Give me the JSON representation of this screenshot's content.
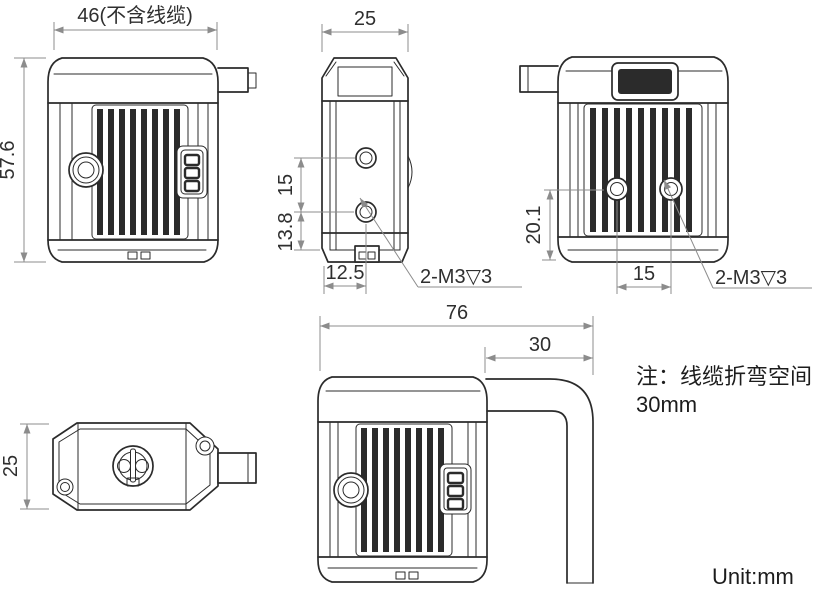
{
  "page": {
    "unit": "Unit:mm",
    "note_line1": "注：线缆折弯空间",
    "note_line2": "30mm"
  },
  "views": {
    "front": {
      "width": "46(不含线缆)",
      "height": "57.6"
    },
    "side": {
      "width": "25",
      "hole_pitch": "15",
      "hole_offset": "13.8",
      "hole_edge": "12.5",
      "thread": "2-M3▽3"
    },
    "rear": {
      "hole_height": "20.1",
      "hole_pitch": "15",
      "thread": "2-M3▽3"
    },
    "top": {
      "depth": "25"
    },
    "cable": {
      "overall_width": "76",
      "bend_space": "30"
    }
  },
  "colors": {
    "line": "#2b2b2b",
    "dimension": "#8c8c8c",
    "background": "#ffffff"
  }
}
